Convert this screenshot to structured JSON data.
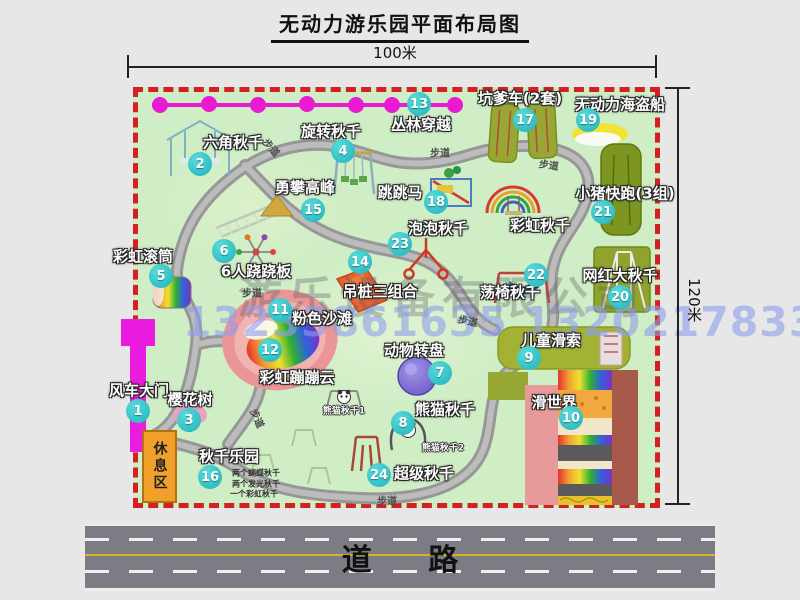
{
  "title": "无动力游乐园平面布局图",
  "dimensions": {
    "width": "100米",
    "height": "120米"
  },
  "road": {
    "label": "道 路"
  },
  "watermark": {
    "company": "游乐设备有限公司",
    "phone": "13233861635 13202178333"
  },
  "park": {
    "path_label": "步道",
    "rest_area": "休息区",
    "rainbow_swing_label": "彩虹秋千",
    "panda_swing_1": "熊猫秋千1",
    "panda_swing_2": "熊猫秋千2",
    "swing_park_notes": [
      "两个蝴蝶秋千",
      "两个发光秋千",
      "一个彩虹秋千"
    ],
    "items": [
      {
        "num": "1",
        "label": "风车大门"
      },
      {
        "num": "2",
        "label": "六角秋千"
      },
      {
        "num": "3",
        "label": "樱花树"
      },
      {
        "num": "4",
        "label": "旋转秋千"
      },
      {
        "num": "5",
        "label": "彩虹滚筒"
      },
      {
        "num": "6",
        "label": "6人跷跷板"
      },
      {
        "num": "7",
        "label": "动物转盘"
      },
      {
        "num": "8",
        "label": "熊猫秋千"
      },
      {
        "num": "9",
        "label": "儿童滑索"
      },
      {
        "num": "10",
        "label": "滑世界"
      },
      {
        "num": "11",
        "label": "粉色沙滩"
      },
      {
        "num": "12",
        "label": "彩虹蹦蹦云"
      },
      {
        "num": "13",
        "label": "丛林穿越"
      },
      {
        "num": "14",
        "label": "吊桩三组合"
      },
      {
        "num": "15",
        "label": "勇攀高峰"
      },
      {
        "num": "16",
        "label": "秋千乐园"
      },
      {
        "num": "17",
        "label": "坑爹车(2套)"
      },
      {
        "num": "18",
        "label": "跳跳马"
      },
      {
        "num": "19",
        "label": "无动力海盗船"
      },
      {
        "num": "20",
        "label": "网红大秋千"
      },
      {
        "num": "21",
        "label": "小猪快跑(3组)"
      },
      {
        "num": "22",
        "label": "荡椅秋千"
      },
      {
        "num": "23",
        "label": "泡泡秋千"
      },
      {
        "num": "24",
        "label": "超级秋千"
      }
    ]
  }
}
